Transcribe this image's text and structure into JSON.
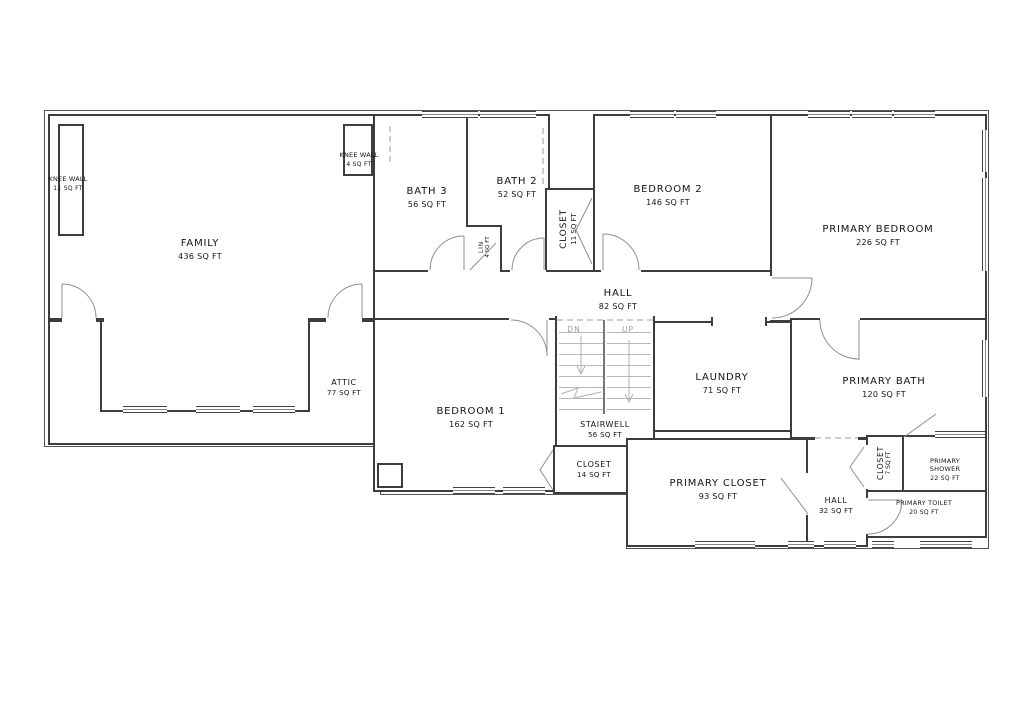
{
  "plan": {
    "type": "floor-plan",
    "units": "SQ FT",
    "colors": {
      "wall": "#3d3d3d",
      "door": "#8f8f8f",
      "stair": "#b8b8b8",
      "text": "#141414"
    },
    "rooms": {
      "family": {
        "name": "FAMILY",
        "area": "436 SQ FT"
      },
      "knee_wall_left": {
        "name": "KNEE WALL",
        "area": "11 SQ FT"
      },
      "knee_wall_top": {
        "name": "KNEE WALL",
        "area": "4 SQ FT"
      },
      "bath3": {
        "name": "BATH 3",
        "area": "56 SQ FT"
      },
      "bath2": {
        "name": "BATH 2",
        "area": "52 SQ FT"
      },
      "linen": {
        "name": "LIN",
        "area": "4 SQ FT"
      },
      "hall_closet": {
        "name": "CLOSET",
        "area": "11 SQ FT"
      },
      "bedroom2": {
        "name": "BEDROOM 2",
        "area": "146 SQ FT"
      },
      "primary_bedroom": {
        "name": "PRIMARY BEDROOM",
        "area": "226 SQ FT"
      },
      "hall_upper": {
        "name": "HALL",
        "area": "82 SQ FT"
      },
      "attic": {
        "name": "ATTIC",
        "area": "77 SQ FT"
      },
      "bedroom1": {
        "name": "BEDROOM 1",
        "area": "162 SQ FT"
      },
      "stairwell": {
        "name": "STAIRWELL",
        "area": "56 SQ FT"
      },
      "laundry": {
        "name": "LAUNDRY",
        "area": "71 SQ FT"
      },
      "primary_bath": {
        "name": "PRIMARY BATH",
        "area": "120 SQ FT"
      },
      "bedroom1_closet": {
        "name": "CLOSET",
        "area": "14 SQ FT"
      },
      "primary_closet": {
        "name": "PRIMARY CLOSET",
        "area": "93 SQ FT"
      },
      "hall_lower": {
        "name": "HALL",
        "area": "32 SQ FT"
      },
      "primary_hall_closet": {
        "name": "CLOSET",
        "area": "7 SQ FT"
      },
      "primary_shower": {
        "name": "PRIMARY SHOWER",
        "area": "22 SQ FT"
      },
      "primary_toilet": {
        "name": "PRIMARY TOILET",
        "area": "20 SQ FT"
      }
    },
    "stairs": {
      "down_label": "DN",
      "up_label": "UP"
    }
  }
}
